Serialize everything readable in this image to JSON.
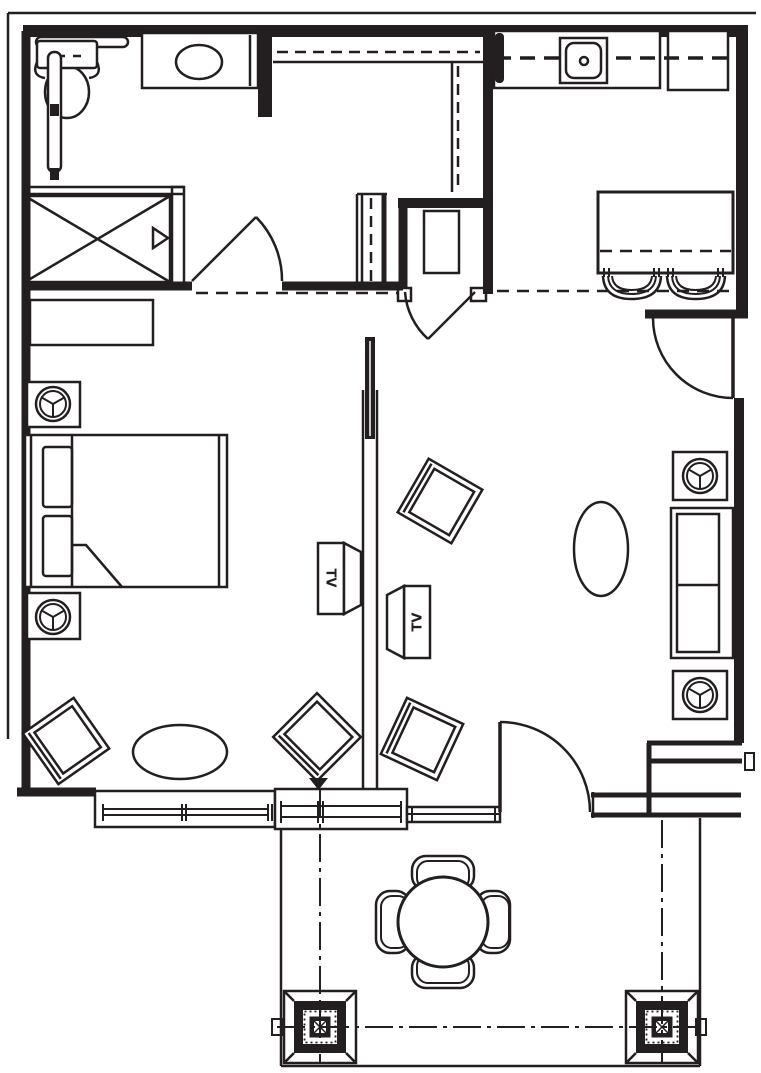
{
  "document": {
    "type": "architectural-floor-plan",
    "background_color": "#ffffff",
    "line_color": "#231f20"
  },
  "labels": {
    "tv_left": "TV",
    "tv_right": "TV"
  },
  "rooms": {
    "bathroom": {
      "fixtures": [
        "toilet",
        "grab-bar",
        "grab-bar",
        "vanity-sink",
        "shower",
        "shower-door-handle",
        "door-swing"
      ]
    },
    "closet": {
      "fixtures": [
        "closet-rod",
        "closet-rod",
        "closet-rod"
      ]
    },
    "entry": {
      "fixtures": [
        "entry-door-swing",
        "floor-mat"
      ]
    },
    "kitchen": {
      "fixtures": [
        "counter",
        "kitchen-sink",
        "refrigerator",
        "upper-cabinet-dashed-line",
        "island-counter",
        "bar-stool",
        "bar-stool",
        "door-swing"
      ]
    },
    "bedroom": {
      "fixtures": [
        "dresser",
        "nightstand-with-lamp",
        "bed",
        "pillow",
        "pillow",
        "nightstand-with-lamp",
        "armchair",
        "ottoman",
        "tv-cabinet"
      ]
    },
    "living_room": {
      "fixtures": [
        "end-table-with-lamp",
        "sofa",
        "end-table-with-lamp",
        "oval-coffee-table",
        "armchair",
        "armchair",
        "armchair",
        "tv-cabinet",
        "patio-door-swing",
        "window",
        "sliding-window"
      ]
    },
    "patio": {
      "fixtures": [
        "round-dining-table",
        "patio-chair",
        "patio-chair",
        "patio-chair",
        "patio-chair",
        "column",
        "column",
        "centerline",
        "centerline",
        "centerline"
      ]
    }
  }
}
